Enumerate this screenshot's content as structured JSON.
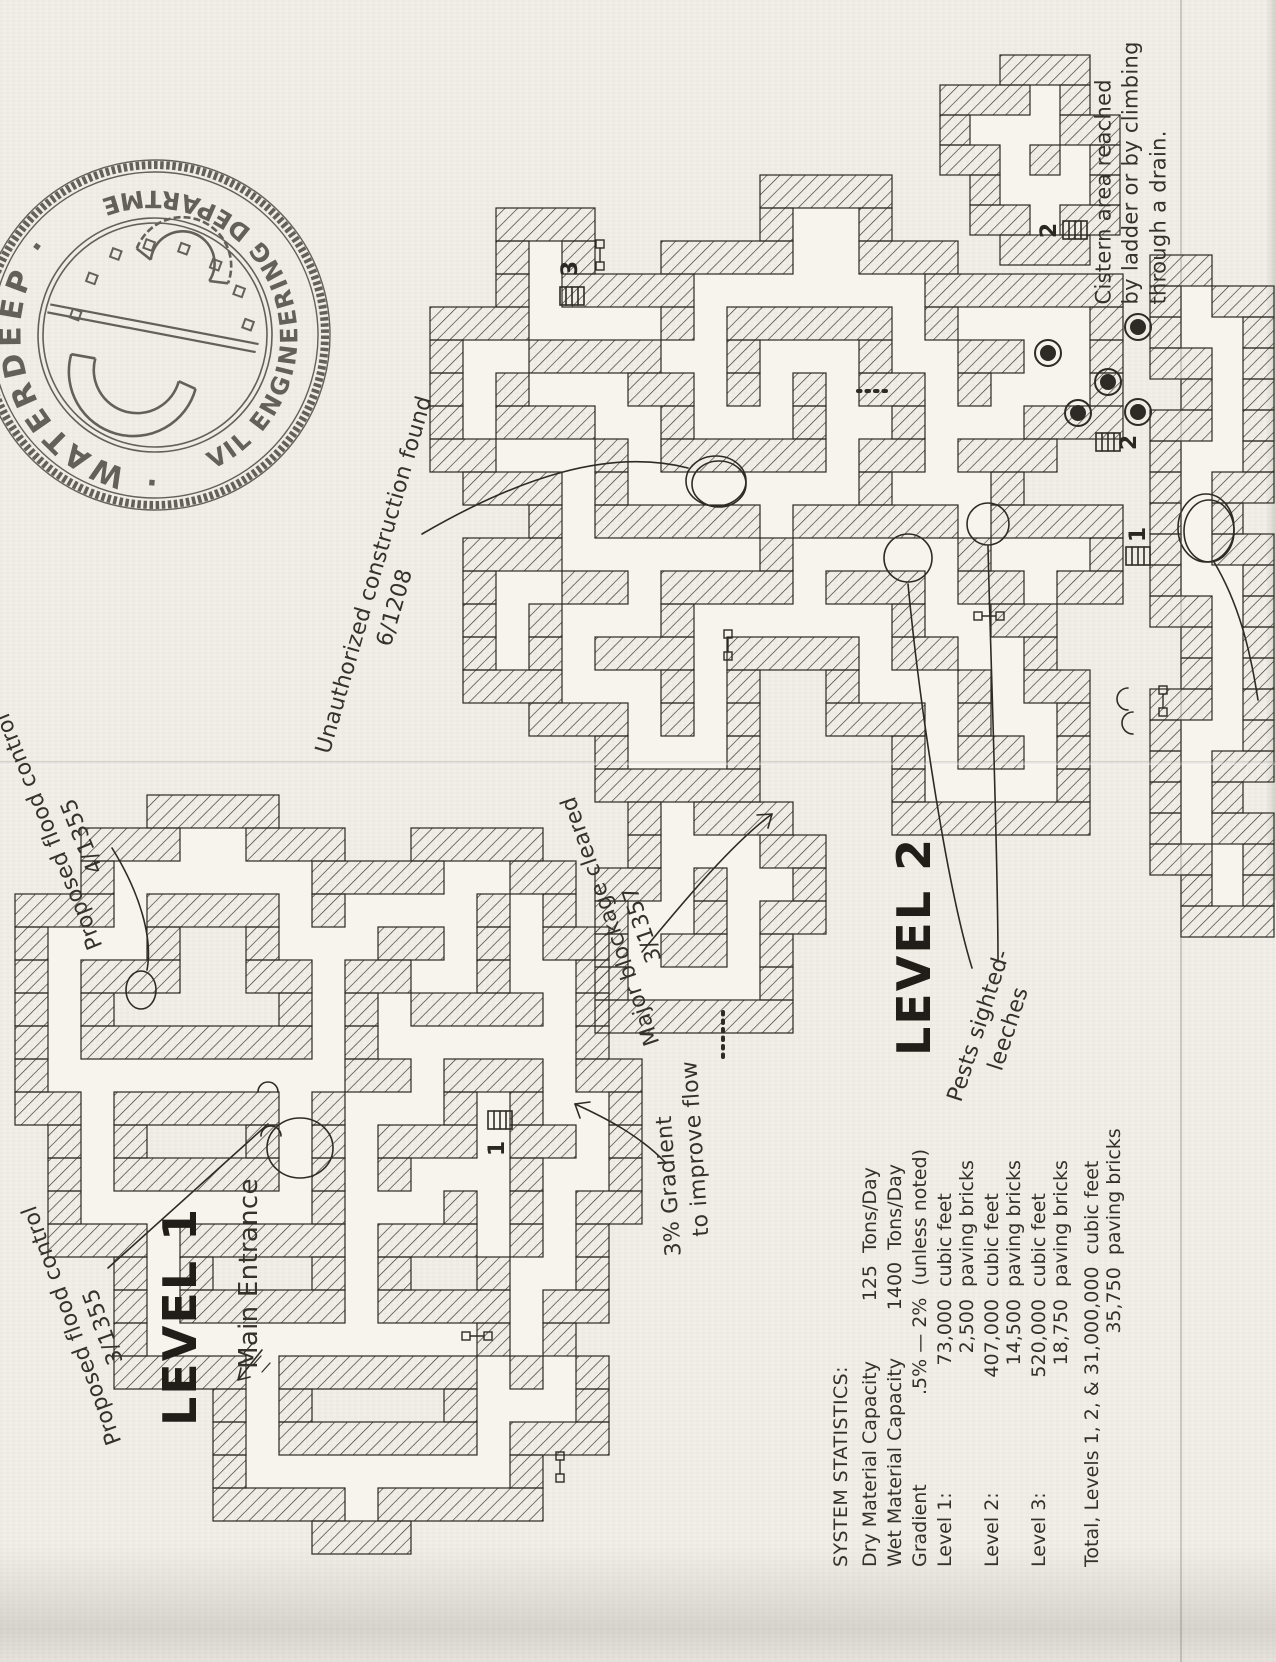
{
  "colors": {
    "paper": "#f2efe8",
    "ink": "#2b2723",
    "stamp_ink": "#44423c"
  },
  "stamp": {
    "org": "WATERDEEP",
    "dept": "CIVIL ENGINEERING DEPARTMENT",
    "separator": "·"
  },
  "levels": {
    "level1": {
      "title": "LEVEL 1",
      "entrance_label": "Main Entrance"
    },
    "level2": {
      "title": "LEVEL 2"
    }
  },
  "markers": {
    "l2_ladder3": "3",
    "l3_ladder2": "2",
    "l2_ladder2": "2",
    "l2_ladder1": "1",
    "l1_ladder1": "1"
  },
  "annotations": {
    "unauthorized": {
      "text": "Unauthorized construction found",
      "date": "6/1208"
    },
    "flood4": {
      "text": "Proposed flood control",
      "date": "4/1355"
    },
    "flood3": {
      "text": "Proposed flood control",
      "date": "3/1355"
    },
    "blockage": {
      "text": "Major blockage cleared",
      "date": "3/1357"
    },
    "pests": {
      "line1": "Pests sighted-",
      "line2": "leeches"
    },
    "gradient": {
      "line1": "3% Gradient",
      "line2": "to improve flow"
    },
    "cistern": {
      "line1": "Cistern area reached",
      "line2": "by ladder or by climbing",
      "line3": "through a drain."
    }
  },
  "stats": {
    "title": "SYSTEM STATISTICS:",
    "rows": [
      {
        "label": "Dry Material Capacity",
        "lines": [
          {
            "value": "125",
            "unit": "Tons/Day"
          }
        ]
      },
      {
        "label": "Wet Material Capacity",
        "lines": [
          {
            "value": "1400",
            "unit": "Tons/Day"
          }
        ]
      },
      {
        "label": "Gradient",
        "lines": [
          {
            "value": ".5% — 2%",
            "unit": "(unless noted)"
          }
        ]
      },
      {
        "label": "Level 1:",
        "lines": [
          {
            "value": "73,000",
            "unit": "cubic feet"
          },
          {
            "value": "2,500",
            "unit": "paving bricks"
          }
        ]
      },
      {
        "label": "Level 2:",
        "lines": [
          {
            "value": "407,000",
            "unit": "cubic feet"
          },
          {
            "value": "14,500",
            "unit": "paving bricks"
          }
        ]
      },
      {
        "label": "Level 3:",
        "lines": [
          {
            "value": "520,000",
            "unit": "cubic feet"
          },
          {
            "value": "18,750",
            "unit": "paving bricks"
          }
        ]
      },
      {
        "label": "Total, Levels 1, 2, & 3",
        "lines": [
          {
            "value": "1,000,000",
            "unit": "cubic feet"
          },
          {
            "value": "35,750",
            "unit": "paving bricks"
          }
        ]
      }
    ]
  }
}
